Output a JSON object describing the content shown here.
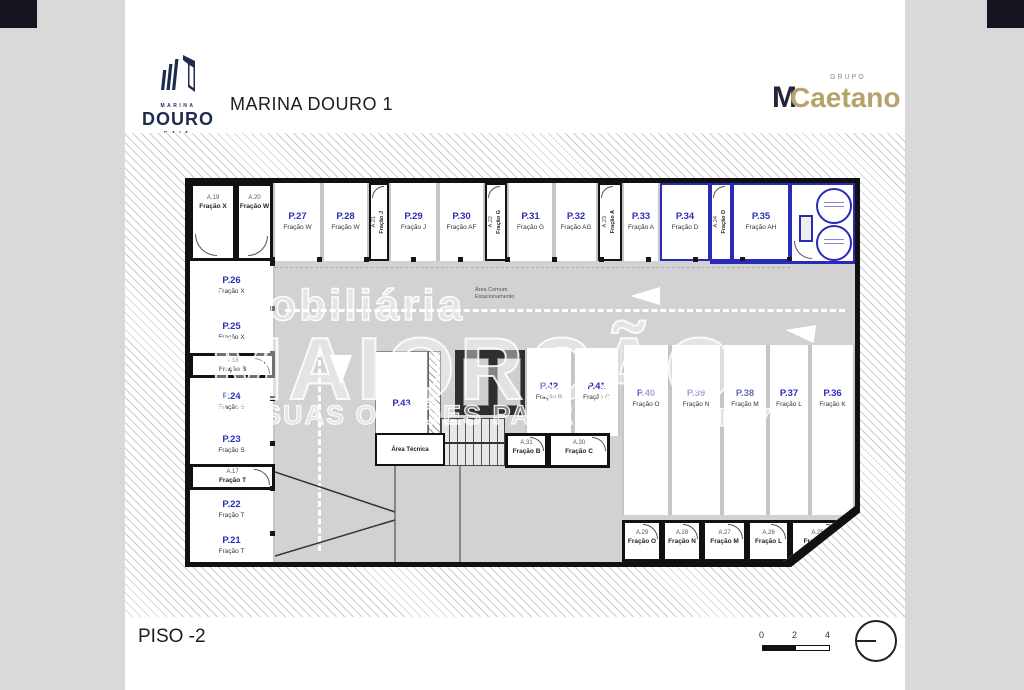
{
  "header": {
    "logo": {
      "marina": "MARINA",
      "douro": "DOURO",
      "gaia": "GAIA"
    },
    "title": "MARINA DOURO 1",
    "grupo": {
      "top": "GRUPO",
      "m": "M",
      "caetano": "Caetano"
    }
  },
  "watermark": {
    "line1": "Imobiliária",
    "line2": "MAIORÇÃO",
    "line3": "AS SUAS OPÇÕES PARA A",
    "ami": "AMI 775"
  },
  "plan": {
    "aisle_label": {
      "l1": "Área Comum",
      "l2": "Estacionamento"
    },
    "area_comum": "Área Comum",
    "area_tecnica": "Área Técnica",
    "top_row": [
      {
        "code": "A.19",
        "fraction": "Fração X"
      },
      {
        "code": "A.20",
        "fraction": "Fração W"
      },
      {
        "code": "P.27",
        "fraction": "Fração W"
      },
      {
        "code": "P.28",
        "fraction": "Fração W"
      },
      {
        "code": "A.21",
        "fraction": "Fração J"
      },
      {
        "code": "P.29",
        "fraction": "Fração J"
      },
      {
        "code": "P.30",
        "fraction": "Fração AF"
      },
      {
        "code": "A.22",
        "fraction": "Fração G"
      },
      {
        "code": "P.31",
        "fraction": "Fração G"
      },
      {
        "code": "P.32",
        "fraction": "Fração AG"
      },
      {
        "code": "A.23",
        "fraction": "Fração A"
      },
      {
        "code": "P.33",
        "fraction": "Fração A"
      },
      {
        "code": "P.34",
        "fraction": "Fração D"
      },
      {
        "code": "A.24",
        "fraction": "Fração D"
      },
      {
        "code": "P.35",
        "fraction": "Fração AH"
      }
    ],
    "left_col": [
      {
        "code": "P.26",
        "fraction": "Fração X"
      },
      {
        "code": "P.25",
        "fraction": "Fração X"
      },
      {
        "code": "A.18",
        "fraction": "Fração S"
      },
      {
        "code": "P.24",
        "fraction": "Fração S"
      },
      {
        "code": "P.23",
        "fraction": "Fração S"
      },
      {
        "code": "A.17",
        "fraction": "Fração T"
      },
      {
        "code": "P.22",
        "fraction": "Fração T"
      },
      {
        "code": "P.21",
        "fraction": "Fração T"
      }
    ],
    "mid": {
      "p43": {
        "code": "P.43"
      },
      "p42": {
        "code": "P.42",
        "fraction": "Fração B"
      },
      "p41": {
        "code": "P.41",
        "fraction": "Fração C"
      },
      "a31": {
        "code": "A.31",
        "fraction": "Fração B"
      },
      "a30": {
        "code": "A.30",
        "fraction": "Fração C"
      }
    },
    "right_row": [
      {
        "code": "P.40",
        "fraction": "Fração O"
      },
      {
        "code": "P.39",
        "fraction": "Fração N"
      },
      {
        "code": "P.38",
        "fraction": "Fração M"
      },
      {
        "code": "P.37",
        "fraction": "Fração L"
      },
      {
        "code": "P.36",
        "fraction": "Fração K"
      }
    ],
    "bottom_row": [
      {
        "code": "A.29",
        "fraction": "Fração O"
      },
      {
        "code": "A.28",
        "fraction": "Fração N"
      },
      {
        "code": "A.27",
        "fraction": "Fração M"
      },
      {
        "code": "A.26",
        "fraction": "Fração L"
      },
      {
        "code": "A.25",
        "fraction": "Fração K"
      }
    ]
  },
  "footer": {
    "floor_label": "PISO -2",
    "scale_ticks": [
      "0",
      "2",
      "4"
    ]
  },
  "colors": {
    "accent_blue": "#2a2ab8",
    "navy": "#1d2b4f",
    "gold": "#b5a36b"
  }
}
